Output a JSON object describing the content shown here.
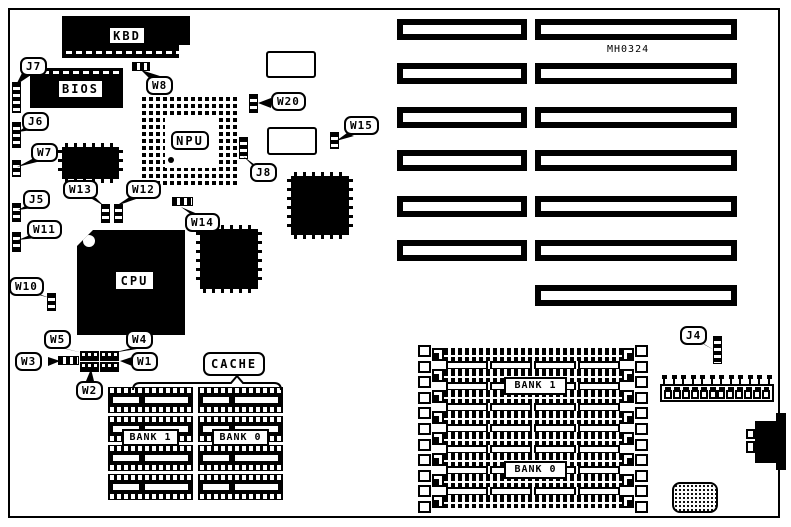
{
  "diagram": {
    "part_number": "MH0324",
    "ink_color": "#000000",
    "background_color": "#ffffff"
  },
  "chips": {
    "kbd": "KBD",
    "bios": "BIOS",
    "npu": "NPU",
    "cpu": "CPU"
  },
  "cache": {
    "title": "CACHE",
    "bank1": "BANK 1",
    "bank0": "BANK 0",
    "chips_per_bank": 4
  },
  "simm": {
    "bank1": "BANK 1",
    "bank0": "BANK 0",
    "socket_rows": 8
  },
  "expansion_slots": {
    "pair_rows": 6,
    "single_rows": 1
  },
  "callouts": {
    "J4": "J4",
    "J5": "J5",
    "J6": "J6",
    "J7": "J7",
    "J8": "J8",
    "W1": "W1",
    "W2": "W2",
    "W3": "W3",
    "W4": "W4",
    "W5": "W5",
    "W7": "W7",
    "W8": "W8",
    "W10": "W10",
    "W11": "W11",
    "W12": "W12",
    "W13": "W13",
    "W14": "W14",
    "W15": "W15",
    "W20": "W20"
  }
}
